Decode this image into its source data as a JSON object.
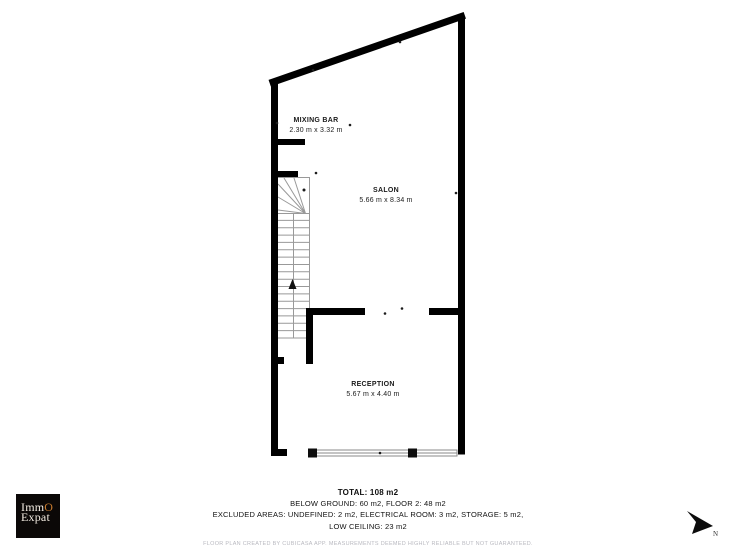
{
  "plan": {
    "rooms": [
      {
        "name": "MIXING BAR",
        "dims": "2.30 m x 3.32 m"
      },
      {
        "name": "SALON",
        "dims": "5.66 m x 8.34 m"
      },
      {
        "name": "RECEPTION",
        "dims": "5.67 m x 4.40 m"
      }
    ]
  },
  "footer": {
    "total": "TOTAL: 108 m2",
    "line2": "BELOW GROUND: 60 m2, FLOOR 2: 48 m2",
    "line3": "EXCLUDED AREAS: UNDEFINED: 2 m2, ELECTRICAL ROOM: 3 m2, STORAGE: 5 m2,",
    "line4": "LOW CEILING: 23 m2",
    "disclaimer": "FLOOR PLAN CREATED BY CUBICASA APP. MEASUREMENTS DEEMED HIGHLY RELIABLE BUT NOT GUARANTEED."
  },
  "logo": {
    "word1_prefix": "Imm",
    "word1_accent": "O",
    "word2": "Expat",
    "accent_color": "#c97b2e"
  },
  "compass": {
    "label": "N"
  },
  "colors": {
    "wall": "#000000",
    "thin_line": "#999999",
    "disclaimer_text": "#b9b9c0",
    "logo_background": "#0b0807"
  }
}
